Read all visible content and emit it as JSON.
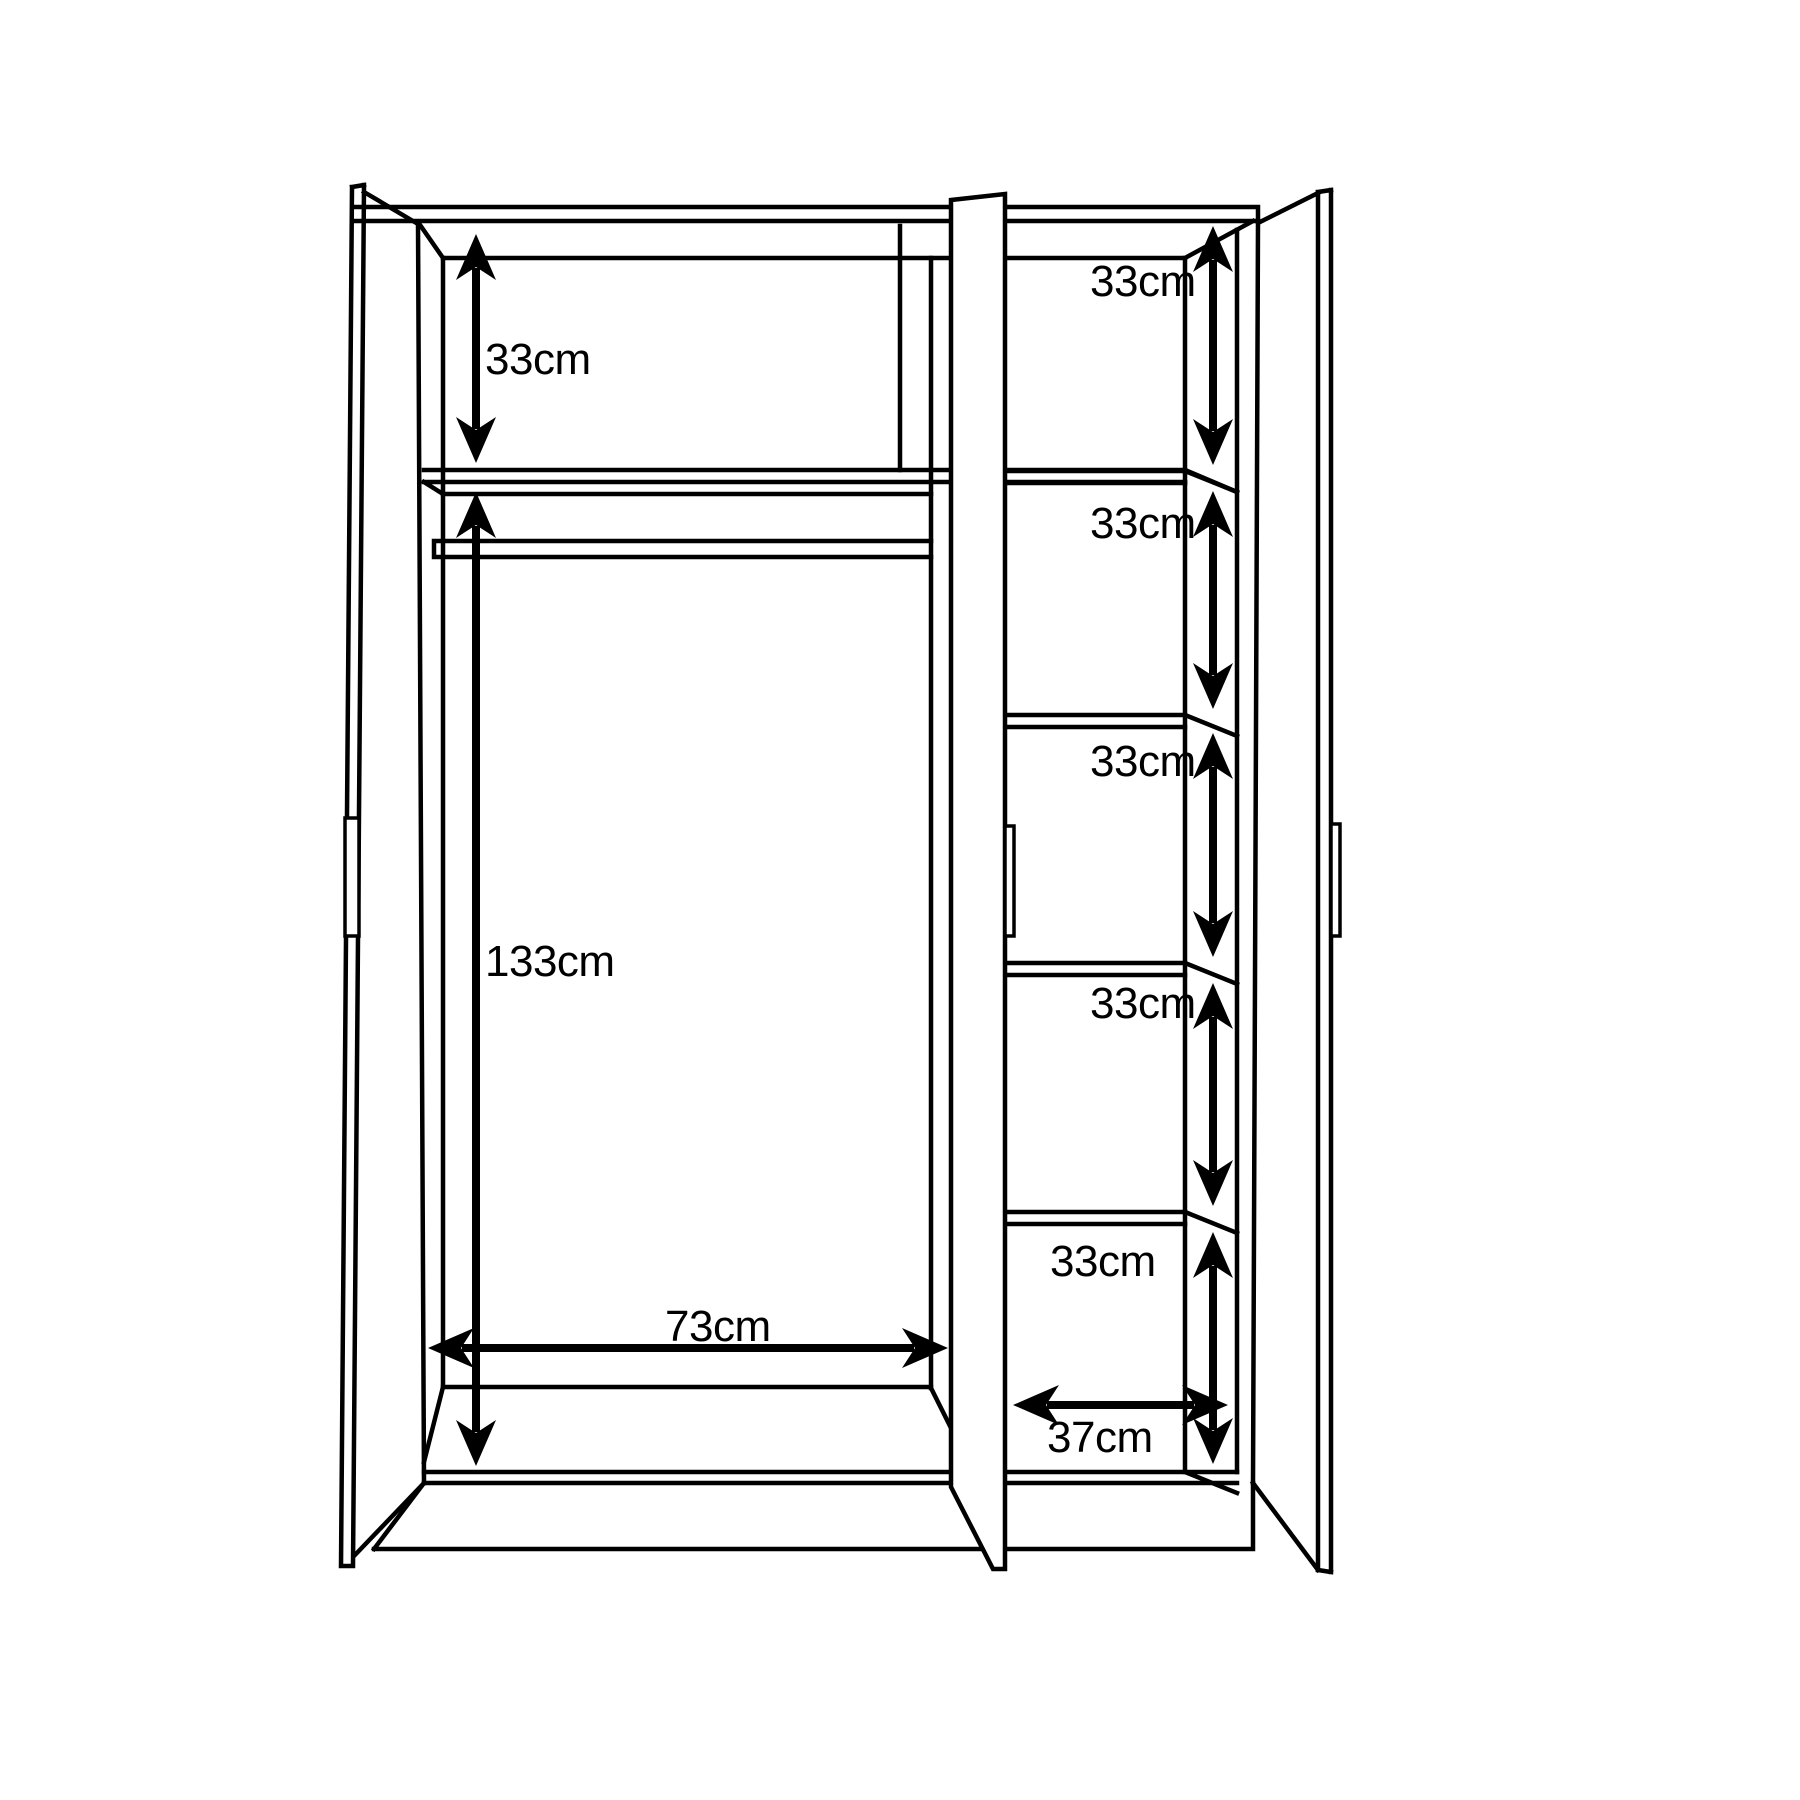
{
  "diagram": {
    "title": "wardrobe-interior-dimension-drawing",
    "colors": {
      "background": "#ffffff",
      "line": "#000000"
    },
    "dimensions": {
      "left_section": {
        "top_shelf_gap": "33cm",
        "hanging_space_height": "133cm",
        "interior_width": "73cm"
      },
      "right_section": {
        "shelves": [
          "33cm",
          "33cm",
          "33cm",
          "33cm",
          "33cm"
        ],
        "interior_width": "37cm"
      }
    }
  }
}
